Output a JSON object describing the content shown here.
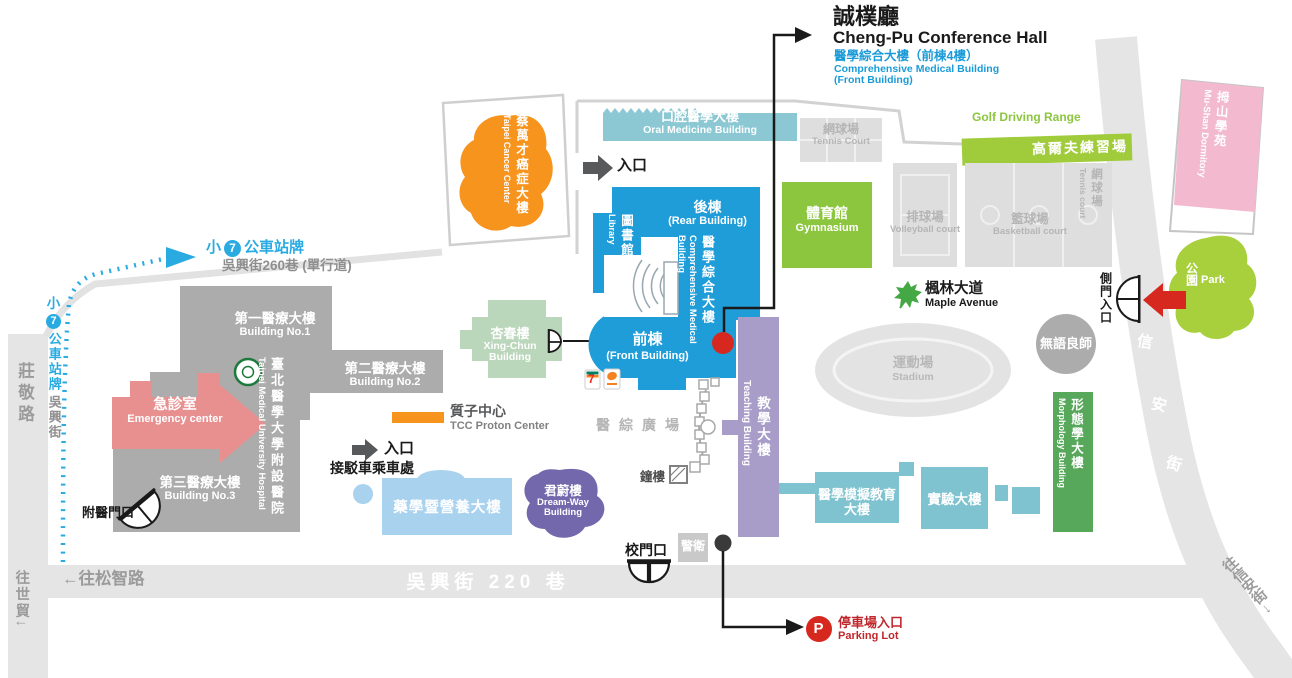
{
  "colors": {
    "main_blue": "#1F9DD9",
    "accent_blue": "#29ABE2",
    "subtitle_blue": "#1B9CD8",
    "green": "#8CC63F",
    "park_green": "#A8CF3C",
    "morph_green": "#58A85B",
    "orange": "#F7941E",
    "pink_dorm": "#F2B9CF",
    "emergency_pink": "#E89090",
    "gray_building": "#ACACAC",
    "road_gray": "#E5E5E5",
    "teal": "#7EC3CF",
    "oral_teal": "#8BC8D3",
    "purple_teaching": "#A79DC8",
    "purple_dreamway": "#7468AC",
    "light_blue": "#A9D2EF",
    "sage": "#BAD6BB",
    "marker_red": "#D6281E"
  },
  "callout": {
    "title_zh": "誠樸廳",
    "title_en": "Cheng-Pu Conference Hall",
    "sub_zh": "醫學綜合大樓（前棟4樓）",
    "sub_en1": "Comprehensive Medical Building",
    "sub_en2": "(Front Building)"
  },
  "buildings": {
    "cancer": {
      "zh": "蔡萬才癌症大樓",
      "en": "Taipei Cancer Center"
    },
    "oral": {
      "zh": "口腔醫學大樓",
      "en": "Oral Medicine Building"
    },
    "tennis_top": {
      "zh": "網球場",
      "en": "Tennis Court"
    },
    "golf": {
      "zh": "高爾夫練習場",
      "en": "Golf Driving Range"
    },
    "gym": {
      "zh": "體育館",
      "en": "Gymnasium"
    },
    "volleyball": {
      "zh": "排球場",
      "en": "Volleyball court"
    },
    "basketball": {
      "zh": "籃球場",
      "en": "Basketball court"
    },
    "tennis_right": {
      "zh": "網球場",
      "en": "Tennis court"
    },
    "dorm": {
      "zh": "拇山學苑",
      "en": "Mu-Shan Dormitory"
    },
    "park": {
      "zh": "公園",
      "en": "Park"
    },
    "no1": {
      "zh": "第一醫療大樓",
      "en": "Building No.1"
    },
    "no2": {
      "zh": "第二醫療大樓",
      "en": "Building No.2"
    },
    "no3": {
      "zh": "第三醫療大樓",
      "en": "Building No.3"
    },
    "hospital": {
      "zh": "臺北醫學大學附設醫院",
      "en": "Taipei Medical University Hospital"
    },
    "emergency": {
      "zh": "急診室",
      "en": "Emergency center"
    },
    "proton": {
      "zh": "質子中心",
      "en": "TCC Proton Center"
    },
    "xingchun": {
      "zh": "杏春樓",
      "en1": "Xing-Chun",
      "en2": "Building"
    },
    "rear": {
      "zh": "後棟",
      "en": "(Rear Building)"
    },
    "library": {
      "zh": "圖書館",
      "en": "Library"
    },
    "cmb": {
      "zh": "醫學綜合大樓",
      "en": "Comprehensive Medical Building"
    },
    "front": {
      "zh": "前棟",
      "en": "(Front Building)"
    },
    "teaching": {
      "zh": "教學大樓",
      "en": "Teaching Building"
    },
    "stadium": {
      "zh": "運動場",
      "en": "Stadium"
    },
    "silent": {
      "zh": "無語良師"
    },
    "sim": {
      "zh1": "醫學模擬教育",
      "zh2": "大樓"
    },
    "lab": {
      "zh": "實驗大樓"
    },
    "morph": {
      "zh": "形態學大樓",
      "en": "Morphology Building"
    },
    "dreamway": {
      "zh": "君蔚樓",
      "en1": "Dream-Way",
      "en2": "Building"
    },
    "pharmacy": {
      "zh": "藥學暨營養大樓"
    }
  },
  "labels": {
    "entrance": "入口",
    "shuttle": "接駁車乘車處",
    "plaza": "醫綜廣場",
    "bell": "鐘樓",
    "guard": "警衛",
    "school_gate": "校門口",
    "side_gate": "側門入口",
    "hospital_gate": "附醫門口",
    "maple_zh": "楓林大道",
    "maple_en": "Maple Avenue",
    "parking_zh": "停車場入口",
    "parking_en": "Parking Lot",
    "parking_p": "P",
    "seven": "7"
  },
  "roads": {
    "zhuangjing": "莊敬路",
    "to_worldtrade": "往世貿↓",
    "to_songzhi": "←往松智路",
    "wuxing220": "吳興街 220 巷",
    "xinan_c1": "信",
    "xinan_c2": "安",
    "xinan_c3": "街",
    "to_xinan": "往信安街→",
    "wuxing260": "吳興街260巷 (單行道)"
  },
  "bus": {
    "prefix": "小",
    "line": "7",
    "stop": "公車站牌",
    "street": "吳興街"
  }
}
